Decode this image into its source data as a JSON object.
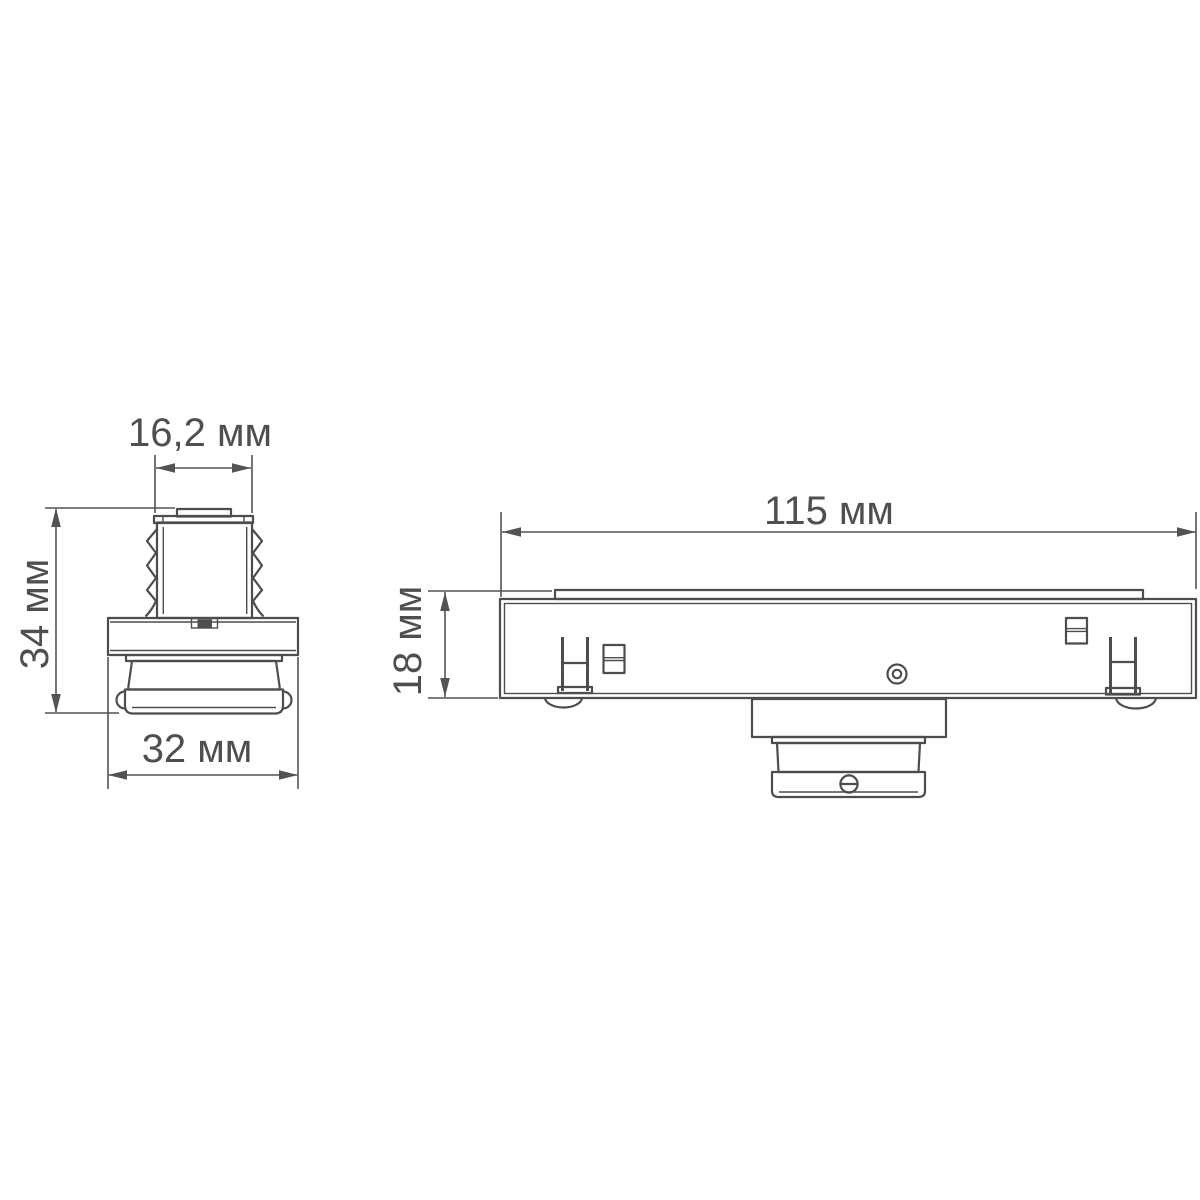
{
  "colors": {
    "background": "#ffffff",
    "line": "#4d4d4d",
    "text": "#4f4f4f"
  },
  "drawing": {
    "kind": "technical-dimension-drawing",
    "unit": "мм",
    "views": [
      {
        "name": "side-view",
        "dimensions": [
          {
            "id": "top-width",
            "label": "16,2 мм",
            "value": "16,2",
            "unit": "мм"
          },
          {
            "id": "overall-height",
            "label": "34 мм",
            "value": "34",
            "unit": "мм"
          },
          {
            "id": "flange-width",
            "label": "32 мм",
            "value": "32",
            "unit": "мм"
          }
        ]
      },
      {
        "name": "front-view",
        "dimensions": [
          {
            "id": "overall-length",
            "label": "115 мм",
            "value": "115",
            "unit": "мм"
          },
          {
            "id": "body-height",
            "label": "18 мм",
            "value": "18",
            "unit": "мм"
          }
        ]
      }
    ]
  }
}
